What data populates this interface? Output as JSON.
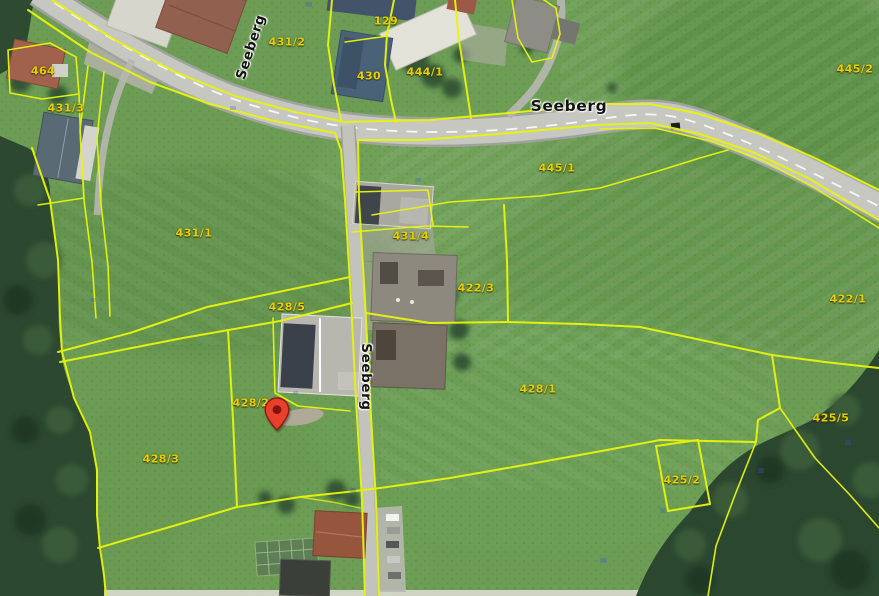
{
  "map": {
    "type": "aerial-cadastral-view",
    "street_name": "Seeberg",
    "street_labels": [
      {
        "text": "Seeberg",
        "x": 251,
        "y": 47,
        "rotation": -72,
        "variant": "rotated"
      },
      {
        "text": "Seeberg",
        "x": 569,
        "y": 106,
        "rotation": 0,
        "variant": "horizontal"
      },
      {
        "text": "Seeberg",
        "x": 366,
        "y": 377,
        "rotation": 90,
        "variant": "rotated"
      }
    ],
    "parcel_labels": [
      {
        "text": "464",
        "x": 43,
        "y": 71
      },
      {
        "text": "431/3",
        "x": 66,
        "y": 108
      },
      {
        "text": "431/2",
        "x": 287,
        "y": 42
      },
      {
        "text": "129",
        "x": 386,
        "y": 21
      },
      {
        "text": "430",
        "x": 369,
        "y": 76
      },
      {
        "text": "444/1",
        "x": 425,
        "y": 72
      },
      {
        "text": "445/2",
        "x": 855,
        "y": 69
      },
      {
        "text": "445/1",
        "x": 557,
        "y": 168
      },
      {
        "text": "431/1",
        "x": 194,
        "y": 233
      },
      {
        "text": "431/4",
        "x": 411,
        "y": 236
      },
      {
        "text": "422/3",
        "x": 476,
        "y": 288
      },
      {
        "text": "422/1",
        "x": 848,
        "y": 299
      },
      {
        "text": "428/5",
        "x": 287,
        "y": 307
      },
      {
        "text": "428/2",
        "x": 251,
        "y": 403
      },
      {
        "text": "428/1",
        "x": 538,
        "y": 389
      },
      {
        "text": "428/3",
        "x": 161,
        "y": 459
      },
      {
        "text": "425/5",
        "x": 831,
        "y": 418
      },
      {
        "text": "425/2",
        "x": 682,
        "y": 480
      }
    ],
    "marker": {
      "icon": "location-pin",
      "x": 277,
      "y": 431
    },
    "colors": {
      "parcel_line": "#e8f50c",
      "parcel_label_text": "#e6ce06",
      "street_label_text": "#121212",
      "pin_red": "#e8402a",
      "field_green": "#6d9c55",
      "forest_green": "#2c4830",
      "road_gray": "#c6c7c1"
    }
  }
}
